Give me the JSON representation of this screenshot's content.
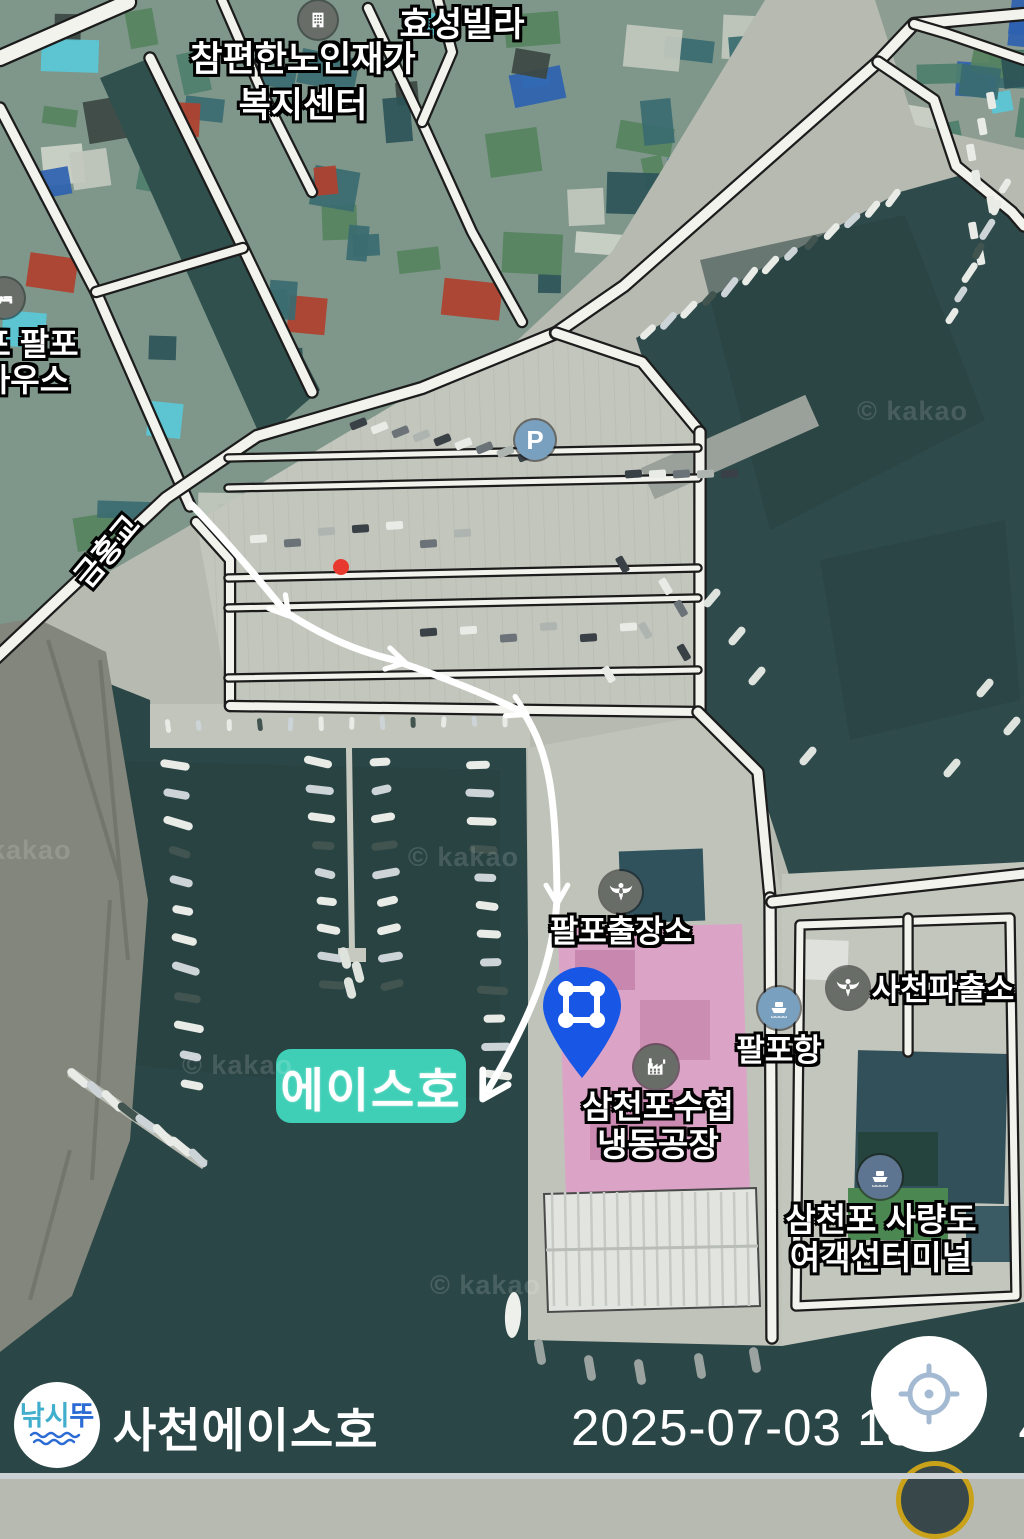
{
  "map": {
    "labels": [
      {
        "id": "hyoseong-villa",
        "text": "효성빌라"
      },
      {
        "id": "welfare-center-line1",
        "text": "참편한노인재가"
      },
      {
        "id": "welfare-center-line2",
        "text": "복지센터"
      },
      {
        "id": "guesthouse-line1",
        "text": "포 팔포"
      },
      {
        "id": "guesthouse-line2",
        "text": "하우스"
      },
      {
        "id": "geumhong-bridge",
        "text": "금홍교"
      },
      {
        "id": "palpo-branch-office",
        "text": "팔포출장소"
      },
      {
        "id": "sacheon-police-box",
        "text": "사천파출소"
      },
      {
        "id": "palpo-port",
        "text": "팔포항"
      },
      {
        "id": "fisheries-coop-line1",
        "text": "삼천포수협"
      },
      {
        "id": "fisheries-coop-line2",
        "text": "냉동공장"
      },
      {
        "id": "ferry-terminal-line1",
        "text": "삼천포 사량도"
      },
      {
        "id": "ferry-terminal-line2",
        "text": "여객선터미널"
      }
    ],
    "highlight_label": "에이스호",
    "watermark": "© kakao",
    "watermark_left": "kakao",
    "parking_letter": "P"
  },
  "footer": {
    "logo_part1": "낚시",
    "logo_part2": "뚜",
    "title": "사천에이스호",
    "timestamp_prefix": "2025-07-03 13:2",
    "timestamp_suffix": "4"
  },
  "colors": {
    "water": "#2e4a4b",
    "land": "#b7bab1",
    "route": "#ffffff",
    "pin_blue": "#1857e6",
    "highlight_teal": "#3ecfb6",
    "highlight_pink": "#ec92ce",
    "logo_teal": "#41aecd",
    "logo_blue": "#2b6bd3",
    "gold_ring": "#caa21a"
  }
}
